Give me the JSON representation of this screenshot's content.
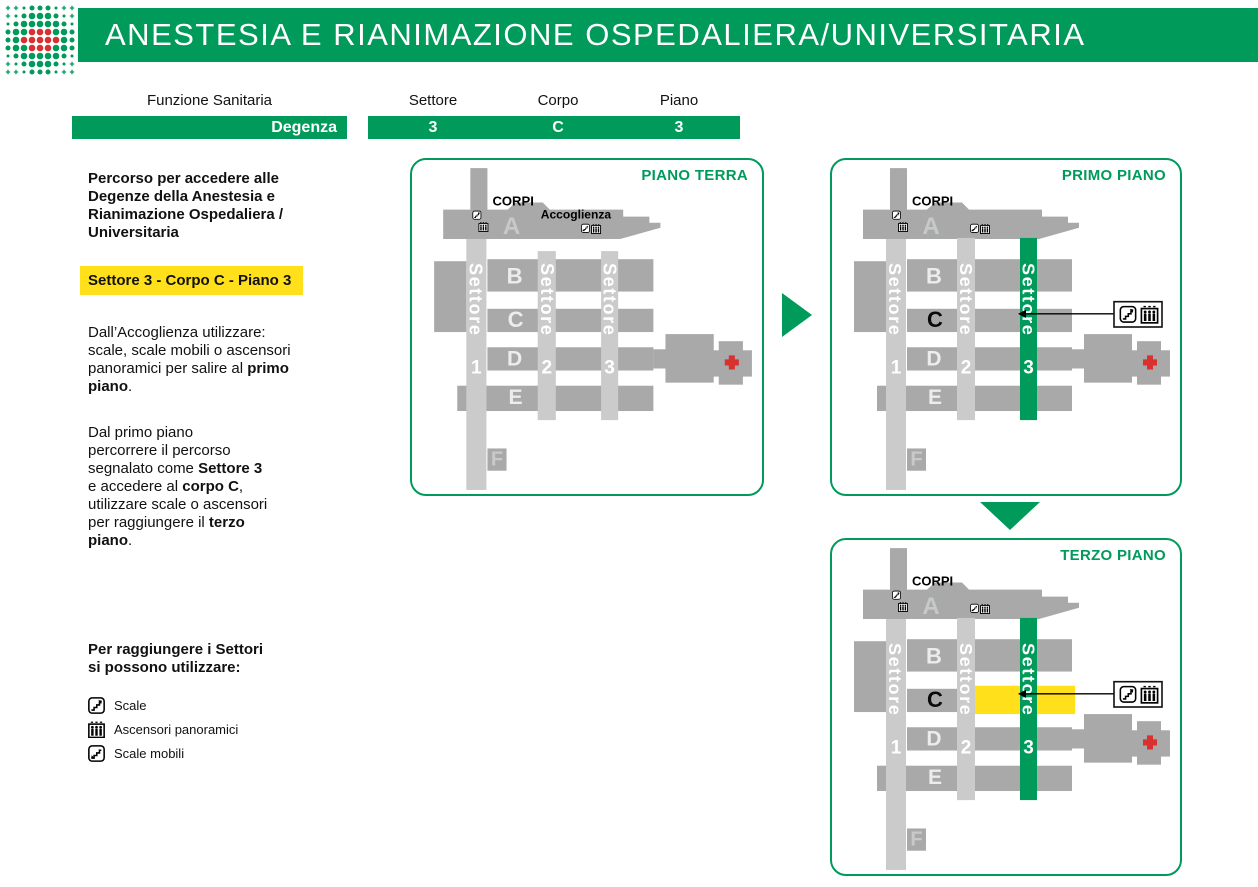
{
  "colors": {
    "green": "#009a5b",
    "yellow": "#ffe01a",
    "red": "#d93030",
    "light_gray": "#cbcbcb",
    "dark_gray": "#a9a9a9",
    "letter_light": "#ececec"
  },
  "header": {
    "title": "ANESTESIA E RIANIMAZIONE OSPEDALIERA/UNIVERSITARIA"
  },
  "logo": {
    "pattern": [
      "ppsmmmspp",
      "psmLLLmsp",
      "smLLLLLms",
      "mLLRRRLLm",
      "mLRRRRRLm",
      "mLLRRRLLm",
      "smLLLLLms",
      "psmLLLmsp",
      "ppsmmmspp"
    ]
  },
  "lookup": {
    "function_label": "Funzione Sanitaria",
    "function_value": "Degenza",
    "columns": [
      {
        "label": "Settore",
        "value": "3"
      },
      {
        "label": "Corpo",
        "value": "C"
      },
      {
        "label": "Piano",
        "value": "3"
      }
    ]
  },
  "sidebar": {
    "intro": "Percorso per accedere alle\nDegenze della Anestesia e\nRianimazione Ospedaliera /\nUniversitaria",
    "highlight": "Settore 3 - Corpo C - Piano 3",
    "paragraphs": [
      {
        "segments": [
          {
            "t": "Dall’Accoglienza utilizzare:\nscale, scale mobili o ascensori\npanoramici per salire al "
          },
          {
            "t": "primo\npiano",
            "b": true
          },
          {
            "t": "."
          }
        ]
      },
      {
        "segments": [
          {
            "t": "Dal primo piano\npercorrere il percorso\nsegnalato come "
          },
          {
            "t": "Settore 3",
            "b": true
          },
          {
            "t": "\ne accedere al "
          },
          {
            "t": "corpo C",
            "b": true
          },
          {
            "t": ",\nutilizzare scale o ascensori\nper raggiungere il "
          },
          {
            "t": "terzo\npiano",
            "b": true
          },
          {
            "t": "."
          }
        ]
      }
    ],
    "legend": {
      "heading": "Per raggiungere i Settori\nsi possono utilizzare:",
      "items": [
        {
          "icon": "stairs-icon",
          "label": "Scale"
        },
        {
          "icon": "panoramic-elevator-icon",
          "label": "Ascensori panoramici"
        },
        {
          "icon": "escalator-icon",
          "label": "Scale mobili"
        }
      ]
    }
  },
  "maps": {
    "labels": {
      "corpi": "CORPI",
      "accoglienza": "Accoglienza",
      "sector_word": "Settore",
      "sector_numbers": [
        "1",
        "2",
        "3"
      ],
      "letters": [
        "A",
        "B",
        "C",
        "D",
        "E",
        "F"
      ]
    },
    "floors": [
      {
        "id": "piano-terra",
        "title": "PIANO TERRA",
        "settore3_green": false,
        "corpo_c_black": false,
        "show_accoglienza": true,
        "yellow_highlight": false,
        "callout": false
      },
      {
        "id": "primo-piano",
        "title": "PRIMO PIANO",
        "settore3_green": true,
        "corpo_c_black": true,
        "show_accoglienza": false,
        "yellow_highlight": false,
        "callout": true
      },
      {
        "id": "terzo-piano",
        "title": "TERZO PIANO",
        "settore3_green": true,
        "corpo_c_black": true,
        "show_accoglienza": false,
        "yellow_highlight": true,
        "callout": true
      }
    ]
  }
}
